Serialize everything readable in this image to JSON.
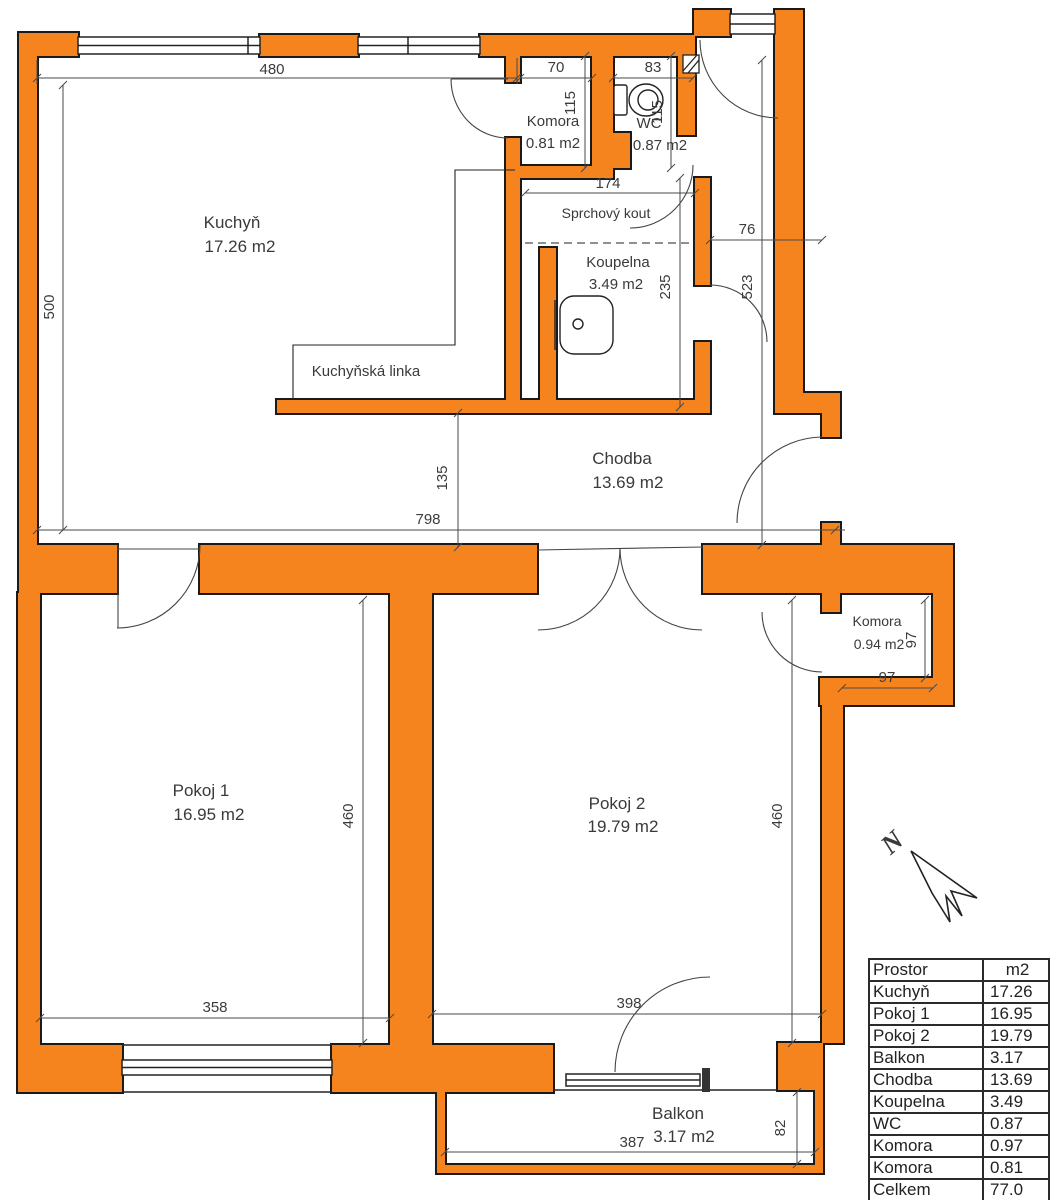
{
  "colors": {
    "wall": "#F5831E",
    "outline": "#1A1A1A",
    "dim_line": "#4A4A4A",
    "text": "#3A3A3A"
  },
  "labels": {
    "kuchyn": {
      "name": "Kuchyň",
      "area": "17.26 m2"
    },
    "komora_top": {
      "name": "Komora",
      "area": "0.81 m2"
    },
    "wc": {
      "name": "WC",
      "area": "0.87 m2"
    },
    "sprchovy_kout": "Sprchový kout",
    "koupelna": {
      "name": "Koupelna",
      "area": "3.49 m2"
    },
    "kuchynska_linka": "Kuchyňská linka",
    "chodba": {
      "name": "Chodba",
      "area": "13.69 m2"
    },
    "pokoj1": {
      "name": "Pokoj 1",
      "area": "16.95 m2"
    },
    "pokoj2": {
      "name": "Pokoj 2",
      "area": "19.79 m2"
    },
    "komora_lower": {
      "name": "Komora",
      "area": "0.94 m2"
    },
    "balkon": {
      "name": "Balkon",
      "area": "3.17 m2"
    },
    "north": "N"
  },
  "dims": {
    "kuchyn_width": "480",
    "komora_width": "70",
    "wc_width": "83",
    "komora_depth": "115",
    "wc_depth": "115",
    "sprcha_width": "174",
    "chodba_width": "76",
    "koupelna_depth": "235",
    "chodba_depth": "523",
    "kuchyn_depth": "500",
    "chodba_135": "135",
    "celek_width": "798",
    "pokoj1_depth": "460",
    "pokoj2_depth": "460",
    "komora2_depth": "97",
    "komora2_width": "97",
    "pokoj1_width": "358",
    "pokoj2_width": "398",
    "balkon_width": "387",
    "balkon_depth": "82"
  },
  "table": {
    "header": [
      "Prostor",
      "m2"
    ],
    "rows": [
      [
        "Kuchyň",
        "17.26"
      ],
      [
        "Pokoj 1",
        "16.95"
      ],
      [
        "Pokoj 2",
        "19.79"
      ],
      [
        "Balkon",
        "3.17"
      ],
      [
        "Chodba",
        "13.69"
      ],
      [
        "Koupelna",
        "3.49"
      ],
      [
        "WC",
        "0.87"
      ],
      [
        "Komora",
        "0.97"
      ],
      [
        "Komora",
        "0.81"
      ],
      [
        "Celkem",
        "77.0"
      ]
    ]
  }
}
